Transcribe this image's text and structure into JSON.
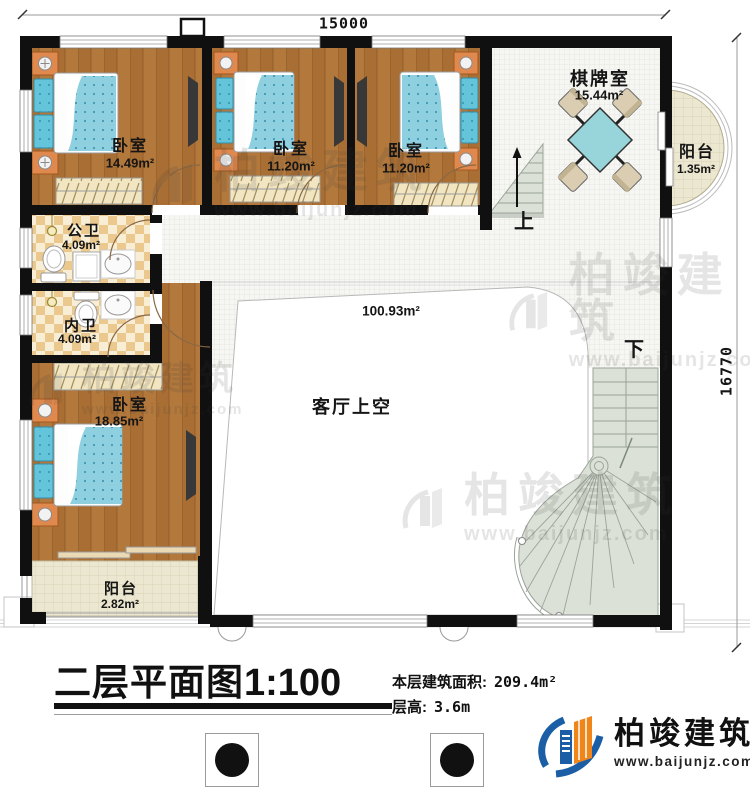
{
  "plan": {
    "dimension_width": "15000",
    "dimension_height": "16770"
  },
  "rooms": {
    "bedroom1": {
      "name": "卧室",
      "area": "14.49m²"
    },
    "bedroom2": {
      "name": "卧室",
      "area": "11.20m²"
    },
    "bedroom3": {
      "name": "卧室",
      "area": "11.20m²"
    },
    "chess_room": {
      "name": "棋牌室",
      "area": "15.44m²"
    },
    "balcony_right": {
      "name": "阳台",
      "area": "1.35m²"
    },
    "public_bathroom": {
      "name": "公卫",
      "area": "4.09m²"
    },
    "private_bathroom": {
      "name": "内卫",
      "area": "4.09m²"
    },
    "bedroom4": {
      "name": "卧室",
      "area": "18.85m²"
    },
    "living_void": {
      "name": "客厅上空",
      "area": "100.93m²"
    },
    "balcony_bottom": {
      "name": "阳台",
      "area": "2.82m²"
    }
  },
  "stairs": {
    "up_label": "上",
    "down_label": "下"
  },
  "title_block": {
    "title": "二层平面图",
    "scale": "1:100",
    "floor_area_label": "本层建筑面积:",
    "floor_area_value": "209.4m²",
    "floor_height_label": "层高:",
    "floor_height_value": "3.6m"
  },
  "brand": {
    "name": "柏竣建筑",
    "website": "www.baijunjz.com"
  },
  "watermark": {
    "name": "柏竣建筑",
    "website": "www.baijunjz.com"
  },
  "colors": {
    "wall": "#111111",
    "wood_floor": "#b1773b",
    "bath_tile": "#eac88e",
    "corridor_tile": "#f6f6f3",
    "balcony_tile": "#ece7d0",
    "bed_blue": "#8fd0e0",
    "stair_green": "#dbe1d6",
    "table_teal": "#97d5da",
    "nightstand_orange": "#e0894f",
    "brand_blue": "#1b5ea6",
    "brand_orange": "#f08519"
  }
}
